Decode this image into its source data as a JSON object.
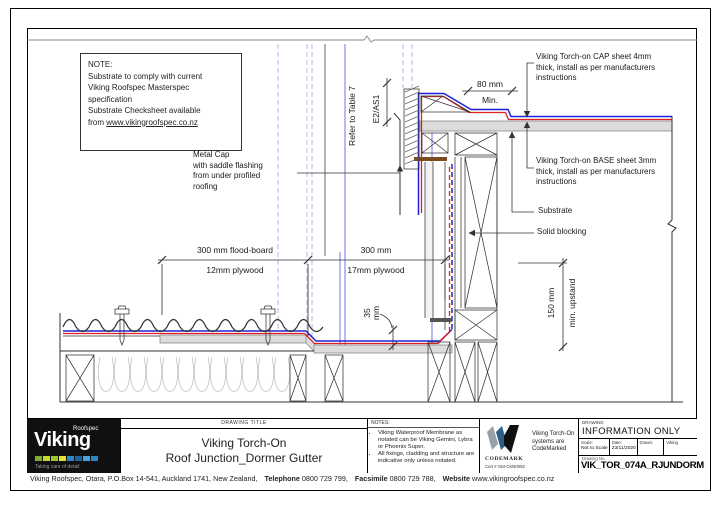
{
  "drawing": {
    "note": {
      "heading": "NOTE:",
      "body": "Substrate to comply with current\nViking Roofspec Masterspec\nspecification\nSubstrate Checksheet available",
      "from_prefix": "from ",
      "url": "www.vikingroofspec.co.nz"
    },
    "labels": {
      "metal_cap": "Metal Cap\nwith saddle flashing\nfrom under profiled\nroofing",
      "cap_sheet": "Viking Torch-on CAP sheet 4mm\nthick, install as per manufacturers\ninstructions",
      "base_sheet": "Viking Torch-on BASE sheet 3mm\nthick, install as per manufacturers\ninstructions",
      "substrate": "Substrate",
      "solid_blocking": "Solid blocking",
      "refer_table": "Refer to Table 7",
      "e2_as1": "E2/AS1"
    },
    "dimensions": {
      "d80": "80 mm",
      "d80_min": "Min.",
      "d300_left": "300 mm flood-board",
      "d300_left_sub": "12mm plywood",
      "d300_right": "300 mm",
      "d300_right_sub": "17mm plywood",
      "d35": "35\nmm",
      "d150": "150 mm",
      "d150_sub": "min. upstand"
    },
    "colors": {
      "membrane_cap_sheet": "#2020d8",
      "membrane_base_sheet": "#e02020",
      "reference_line": "#a2a2ee",
      "substrate_fill": "#dcdcdc",
      "timber_cap": "#7a4a21"
    }
  },
  "title_block": {
    "logo": {
      "brand": "Viking",
      "series": "Roofspec",
      "tagline": "Taking care of detail"
    },
    "drawing_title": {
      "heading": "DRAWING TITLE",
      "line1": "Viking Torch-On",
      "line2": "Roof Junction_Dormer Gutter"
    },
    "notes": {
      "heading": "NOTES:",
      "bullets": [
        "Viking Waterproof Membrane as notated can be Viking Gemini, Lybra or Phoenix Super.",
        "All fixings, cladding and structure are indicative only unless notated."
      ]
    },
    "codemark": {
      "name": "CODEMARK",
      "cert": "Cert # GM-CM30092",
      "caption": "Viking Torch-On\nsystems are\nCodeMarked"
    },
    "info": {
      "heading": "DRAWING",
      "status": "INFORMATION ONLY",
      "fields": [
        {
          "label": "Scale:",
          "value": "Not to Scale"
        },
        {
          "label": "Date:",
          "value": "23/11/2020"
        },
        {
          "label": "Drawn:",
          "value": ""
        },
        {
          "label": "Viking",
          "value": ""
        }
      ],
      "drawing_no_label": "Drawing No.",
      "drawing_no": "VIK_TOR_074A_RJUNDORM"
    }
  },
  "footer": {
    "address": "Viking Roofspec, Otara, P.O.Box 14-541, Auckland 1741, New Zealand,",
    "phone_label": "Telephone",
    "phone": "0800 729 799,",
    "fax_label": "Facsimile",
    "fax": "0800 729 788,",
    "web_label": "Website",
    "web": "www.vikingroofspec.co.nz"
  }
}
